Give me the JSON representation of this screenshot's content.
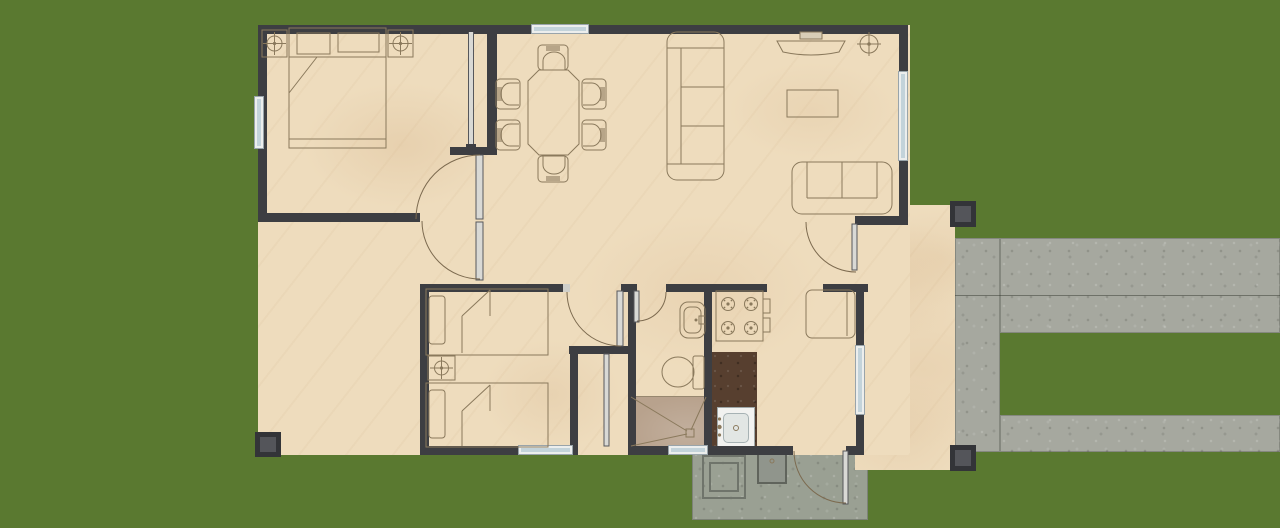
{
  "scene": {
    "type": "architectural-floor-plan",
    "description": "Top-down floor plan of a small two-bedroom house on a grass lawn: master bedroom, dining area, living room, second bedroom with twin beds, bathroom, kitchen, open porches with columns, rear concrete laundry patio and a C-shaped concrete walkway on the right"
  },
  "palette": {
    "grass": "#5a7930",
    "grass_dark": "#3c5520",
    "grass_light": "#7e9b4e",
    "concrete": "#a6a89f",
    "concrete_seam": "#3d4236",
    "patio_concrete": "#9aa093",
    "floor": "#eedcbd",
    "wall": "#3d3e42",
    "window_frame": "#eceeed",
    "window_glass": "#c3d3da",
    "furniture_line": "#8a795c",
    "door_leaf": "#d9d9d5",
    "door_arc": "#7c6a4f",
    "shower_floor": "#b8a28d",
    "counter_top": "#573f2f",
    "sink_white": "#f2f2f0",
    "sink_inner": "#e2e6e4",
    "column_outer": "#333438",
    "column_inner": "#54555a",
    "tub": "#90958c",
    "laundry_line": "#6f746b"
  }
}
